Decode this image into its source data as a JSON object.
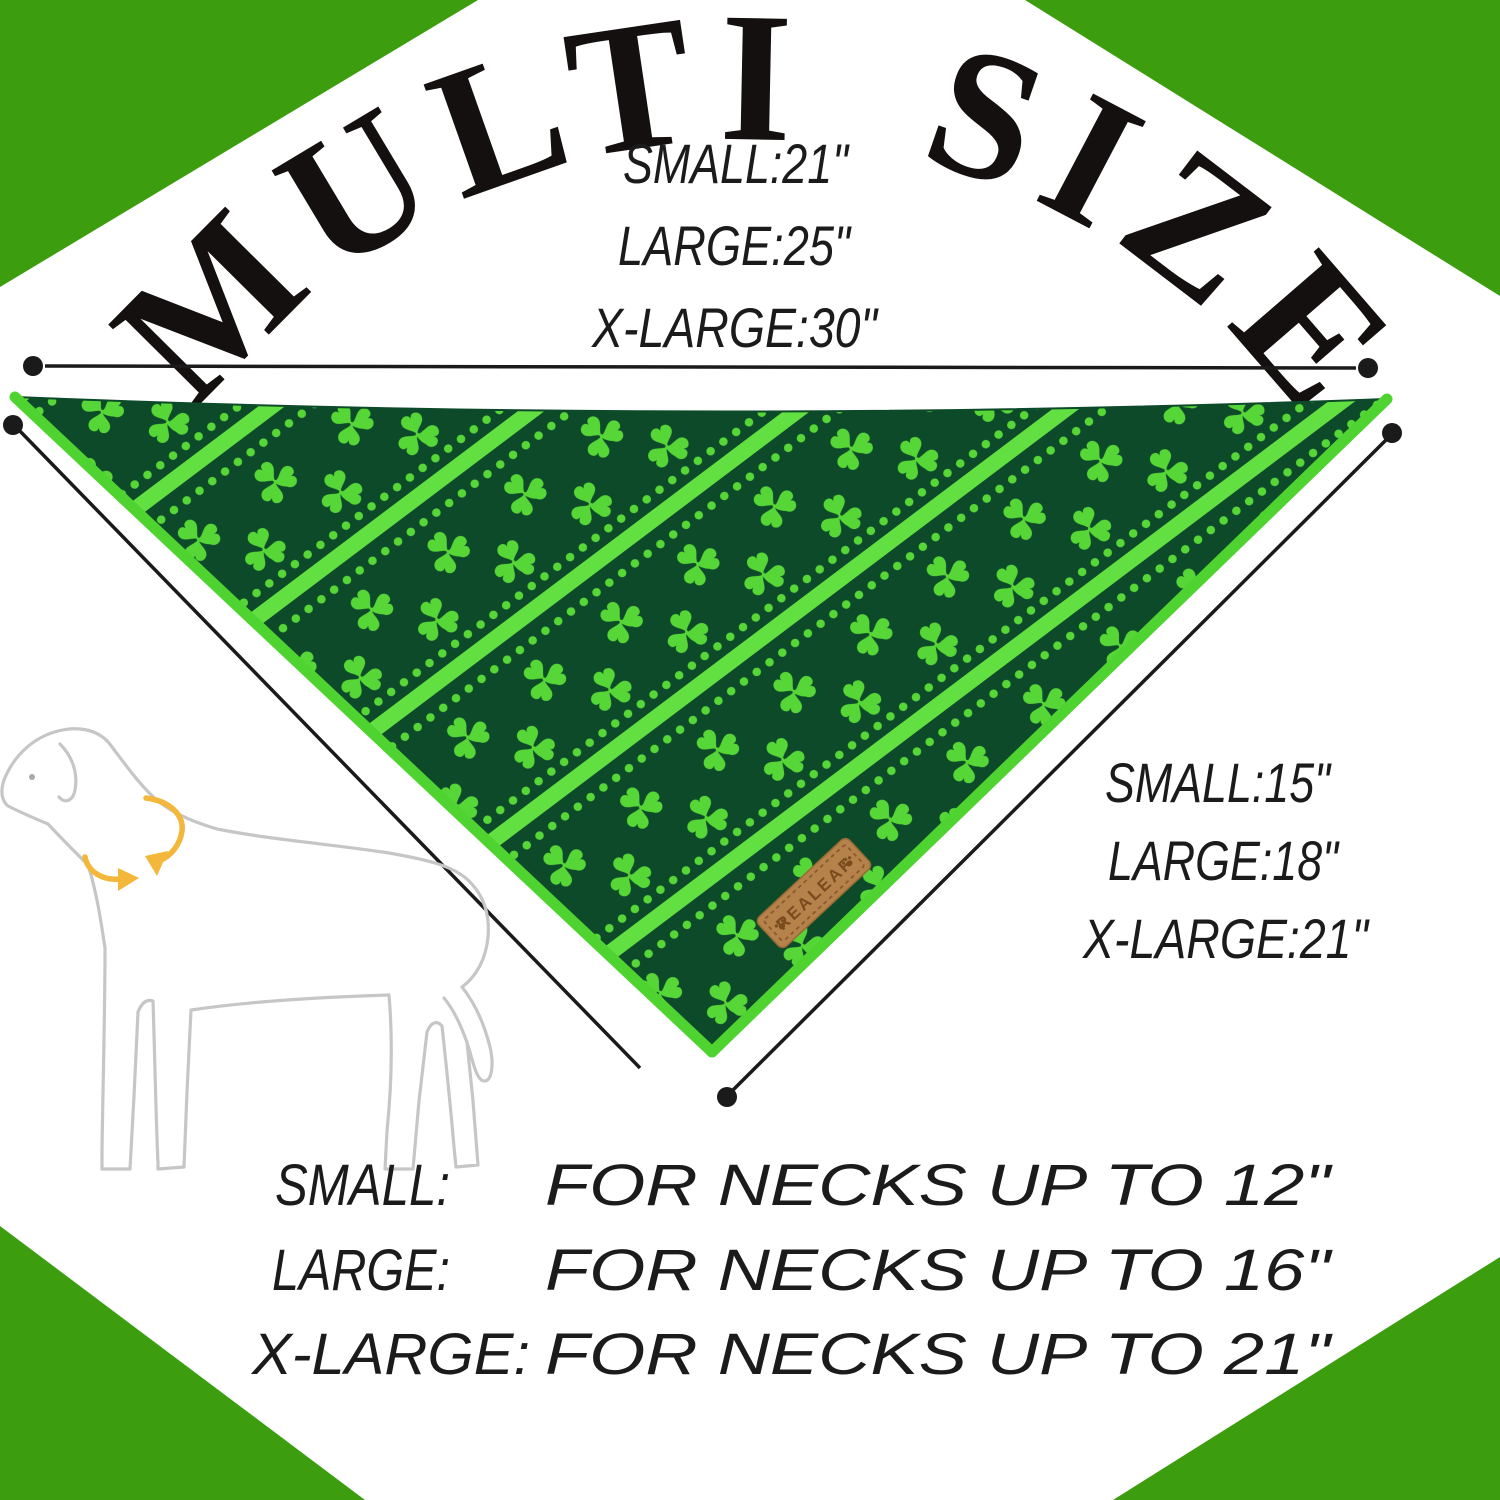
{
  "title": "MULTI SIZE",
  "top_sizes": {
    "small": "SMALL:21\"",
    "large": "LARGE:25\"",
    "xlarge": "X-LARGE:30\""
  },
  "edge_sizes": {
    "small": "SMALL:15\"",
    "large": "LARGE:18\"",
    "xlarge": "X-LARGE:21\""
  },
  "neck_fit": {
    "rows": [
      {
        "label": "SMALL:",
        "desc": "FOR NECKS UP TO 12\""
      },
      {
        "label": "LARGE:",
        "desc": "FOR NECKS UP TO 16\""
      },
      {
        "label": "X-LARGE:",
        "desc": "FOR NECKS UP TO 21\""
      }
    ]
  },
  "brand": {
    "label": "REALEAF"
  },
  "icons": [
    "shamrock-icon",
    "paw-icon",
    "measure-dot-icon",
    "neck-arrow-icon"
  ],
  "colors": {
    "corner_green": "#3c9d0e",
    "bandana_dark": "#0d4a2a",
    "shamrock_green": "#57d737",
    "stripe_green": "#63e041",
    "binding_green": "#4fd331",
    "label_tan": "#b5824c",
    "label_brown": "#7a4b1d",
    "stitch_brown": "#8a5a28",
    "arrow_gold": "#f2b73b",
    "line_black": "#1a1a1a",
    "dog_gray": "#c6c6c6"
  }
}
